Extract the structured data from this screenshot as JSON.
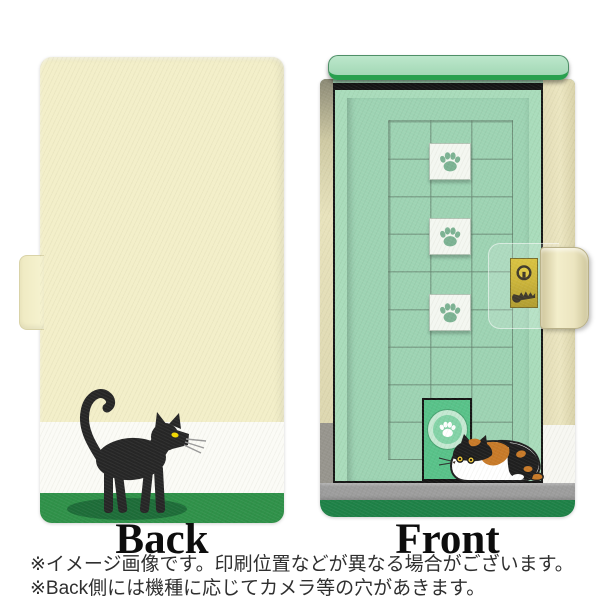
{
  "labels": {
    "back": "Back",
    "front": "Front"
  },
  "notes": [
    "※イメージ画像です。印刷位置などが異なる場合がございます。",
    "※Back側には機種に応じてカメラ等の穴があきます。"
  ],
  "icons": {
    "paw_print": "paw-print-icon",
    "keyhole": "keyhole-icon",
    "key": "key-icon"
  },
  "colors": {
    "back_cream": "#f3efc9",
    "white_stripe": "#fbfbf6",
    "back_green": "#2f9149",
    "shadow_green": "#1d6c38",
    "cat_black": "#262626",
    "eye_yellow": "#f2d800",
    "front_green_light": "#a9dcbb",
    "door_panel_green": "#9dd3b3",
    "awning_edge_green": "#28a04e",
    "cat_door_green": "#58c289",
    "paw_tile_white": "#f4f7f1",
    "paw_green": "#7cb393",
    "lock_gold": "#c3a713",
    "floor_gray": "#9d9d9d",
    "base_green": "#1e8147",
    "spine_cream": "#ece6c1",
    "calico_orange": "#c87a28"
  }
}
